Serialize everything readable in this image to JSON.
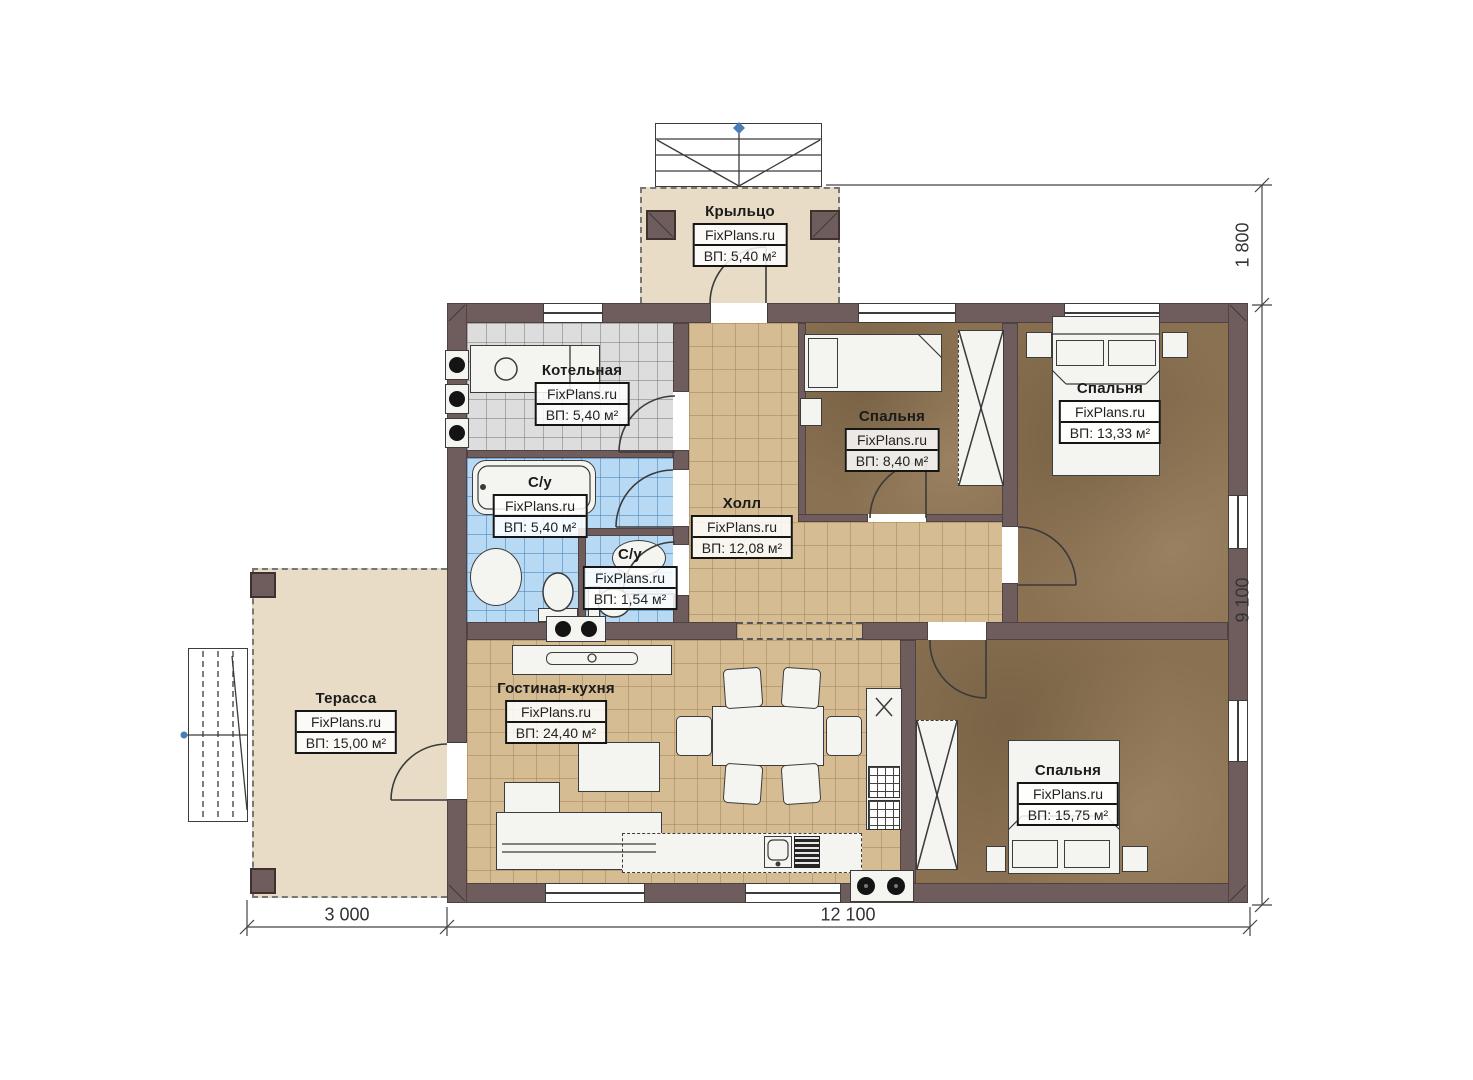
{
  "plan_title": "Floor plan of a single-storey house",
  "rooms": {
    "porch": {
      "name": "Крыльцо",
      "brand": "FixPlans.ru",
      "area": "ВП: 5,40 м²"
    },
    "boiler": {
      "name": "Котельная",
      "brand": "FixPlans.ru",
      "area": "ВП: 5,40 м²"
    },
    "bathroom": {
      "name": "С/у",
      "brand": "FixPlans.ru",
      "area": "ВП: 5,40 м²"
    },
    "wc": {
      "name": "С/у",
      "brand": "FixPlans.ru",
      "area": "ВП: 1,54 м²"
    },
    "hall": {
      "name": "Холл",
      "brand": "FixPlans.ru",
      "area": "ВП: 12,08 м²"
    },
    "bedroom_top": {
      "name": "Спальня",
      "brand": "FixPlans.ru",
      "area": "ВП: 8,40 м²"
    },
    "bedroom_right": {
      "name": "Спальня",
      "brand": "FixPlans.ru",
      "area": "ВП: 13,33 м²"
    },
    "living": {
      "name": "Гостиная-кухня",
      "brand": "FixPlans.ru",
      "area": "ВП: 24,40 м²"
    },
    "bedroom_bottom": {
      "name": "Спальня",
      "brand": "FixPlans.ru",
      "area": "ВП: 15,75 м²"
    },
    "terrace": {
      "name": "Терасса",
      "brand": "FixPlans.ru",
      "area": "ВП: 15,00 м²"
    }
  },
  "dimensions": {
    "porch_depth": "1 800",
    "house_height": "9 100",
    "terrace_width": "3 000",
    "house_width": "12 100"
  },
  "colors": {
    "wall": "#6f5d5d",
    "floor_tile_tan": "#d6bc92",
    "floor_tile_gray": "#dddddd",
    "floor_tile_blue": "#b7d9f3",
    "floor_bedroom_brown": "#8a7152",
    "porch_terrace_beige": "#e8dcc6",
    "marker_blue": "#4a7fb5",
    "linework": "#3a3a3a"
  }
}
